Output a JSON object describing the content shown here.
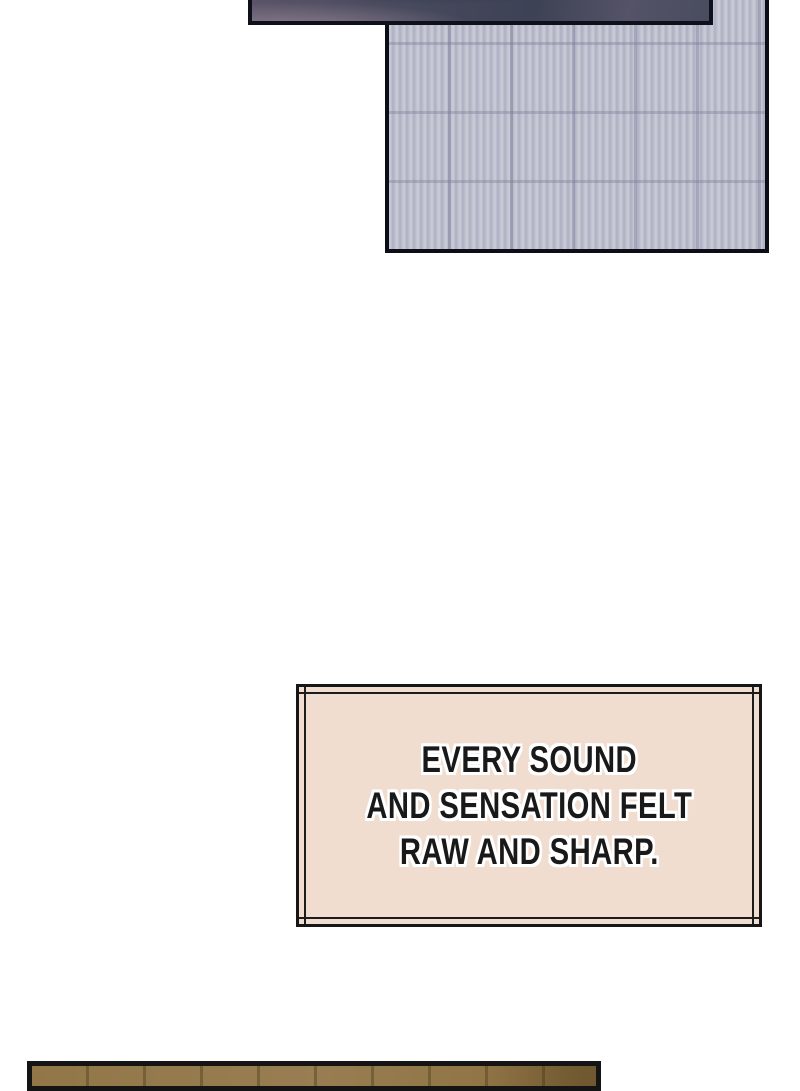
{
  "page": {
    "background_color": "#ffffff"
  },
  "panels": {
    "sky": {
      "border_color": "#0e111c",
      "color_dark": "#3e4255",
      "color_light": "#897a8c"
    },
    "wall": {
      "border_color": "#0b0e17",
      "base_color": "#b8bac9",
      "stripe_light": "#c7c9d5",
      "seam_color": "#787c94"
    },
    "floor": {
      "border_color": "#141414",
      "base_color": "#8c6f3e"
    }
  },
  "caption": {
    "lines": [
      "EVERY SOUND",
      "AND SENSATION FELT",
      "RAW AND SHARP."
    ],
    "full_text": "EVERY SOUND AND SENSATION FELT RAW AND SHARP.",
    "background_color": "#f0ddd0",
    "border_color": "#161616",
    "text_color": "#191919",
    "outline_color": "#ffffff"
  }
}
